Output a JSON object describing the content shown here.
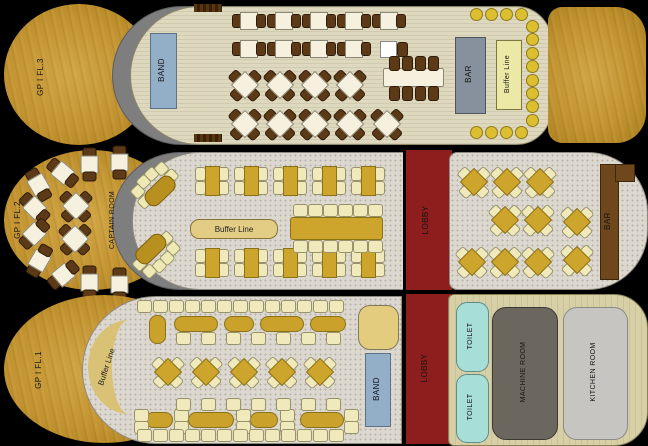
{
  "labels": {
    "deck3": {
      "floor": "GP I FL.3",
      "band": "BAND",
      "bar": "BAR",
      "buffet": "Buffer Line"
    },
    "deck2": {
      "floor": "GP I FL.2",
      "captain_room": "CAPTAIN ROOM",
      "buffet": "Buffer Line",
      "lobby": "LOBBY",
      "bar": "BAR"
    },
    "deck1": {
      "floor": "GP I FL.1",
      "buffet": "Buffer Line",
      "band": "BAND",
      "lobby": "LOBBY",
      "toilet_1": "TOILET",
      "toilet_2": "TOILET",
      "machine_room": "MACHINE  ROOM",
      "kitchen_room": "KITCHEN  ROOM"
    }
  },
  "colors": {
    "background": "#000000",
    "hull_wood": "#c29330",
    "hull_gray": "#7e7e7e",
    "deck_plank": "#ded8bf",
    "deck_carpet": "#dcd8d0",
    "lobby_red": "#8e1d1d",
    "band_blue": "#93aec7",
    "bar_gray": "#87909d",
    "bar_brown": "#6f471d",
    "buffet_yellow": "#ece8a5",
    "table_gold": "#cda52c",
    "chair_brown": "#5c3a18",
    "chair_cream": "#efe9bb",
    "stool_yellow": "#dcbf30",
    "toilet_cyan": "#a7ded7",
    "machine_gray": "#6b675f",
    "kitchen_gray": "#c6c5c2"
  },
  "furniture": {
    "fl3": [
      {
        "t": "hatch",
        "x": 190,
        "y": 0,
        "w": 28,
        "h": 8
      },
      {
        "t": "hatch",
        "x": 190,
        "y": 130,
        "w": 28,
        "h": 8
      },
      {
        "t": "row",
        "c": "t2h",
        "x": 228,
        "y": 8,
        "n": 5,
        "dx": 35
      },
      {
        "t": "row",
        "c": "t2h",
        "x": 228,
        "y": 36,
        "n": 4,
        "dx": 35
      },
      {
        "t": "wsq",
        "x": 376,
        "y": 37
      },
      {
        "t": "chb",
        "x": 393,
        "y": 38
      },
      {
        "t": "ltw",
        "x": 379,
        "y": 64,
        "w": 59,
        "h": 17
      },
      {
        "t": "row",
        "c": "chb",
        "x": 385,
        "y": 52,
        "n": 4,
        "dx": 13
      },
      {
        "t": "row",
        "c": "chb",
        "x": 385,
        "y": 82,
        "n": 4,
        "dx": 13
      },
      {
        "t": "row",
        "c": "dmb",
        "x": 223,
        "y": 63,
        "n": 4,
        "dx": 35
      },
      {
        "t": "row",
        "c": "dmb",
        "x": 223,
        "y": 102,
        "n": 4,
        "dx": 35
      },
      {
        "t": "dmb",
        "x": 365,
        "y": 102
      },
      {
        "t": "row",
        "c": "stool",
        "x": 466,
        "y": 4,
        "n": 4,
        "dx": 15
      },
      {
        "t": "row",
        "c": "stool",
        "x": 522,
        "y": 16,
        "n": 8,
        "dy": 13.4
      },
      {
        "t": "row",
        "c": "stool",
        "x": 466,
        "y": 122,
        "n": 4,
        "dx": 15
      }
    ],
    "fl2": [
      {
        "t": "t2h",
        "x": 69,
        "y": 6,
        "r": 90
      },
      {
        "t": "t2h",
        "x": 99,
        "y": 4,
        "r": 90
      },
      {
        "t": "t2h",
        "x": 42,
        "y": 14,
        "r": 40
      },
      {
        "t": "t2h",
        "x": 18,
        "y": 26,
        "r": 60
      },
      {
        "t": "t2h",
        "x": 14,
        "y": 49,
        "r": 45
      },
      {
        "t": "t2h",
        "x": 13,
        "y": 75,
        "r": -45
      },
      {
        "t": "dmb",
        "x": 54,
        "y": 38
      },
      {
        "t": "dmb",
        "x": 53,
        "y": 71
      },
      {
        "t": "t2h",
        "x": 18,
        "y": 102,
        "r": -60
      },
      {
        "t": "t2h",
        "x": 42,
        "y": 116,
        "r": -40
      },
      {
        "t": "t2h",
        "x": 69,
        "y": 124,
        "r": 90
      },
      {
        "t": "t2h",
        "x": 99,
        "y": 126,
        "r": 90
      },
      {
        "t": "sofa",
        "x": 130,
        "y": 18,
        "r": -44
      },
      {
        "t": "sofa",
        "x": 127,
        "y": 84,
        "r": 136
      },
      {
        "t": "row",
        "c": "u4",
        "x": 191,
        "y": 16,
        "n": 5,
        "dx": 39
      },
      {
        "t": "row",
        "c": "u4",
        "x": 191,
        "y": 98,
        "n": 5,
        "dx": 39
      },
      {
        "t": "ltg",
        "x": 286,
        "y": 67,
        "w": 91,
        "h": 21
      },
      {
        "t": "row",
        "c": "chc",
        "x": 289,
        "y": 54,
        "n": 6,
        "dx": 15
      },
      {
        "t": "row",
        "c": "chc",
        "x": 289,
        "y": 90,
        "n": 6,
        "dx": 15
      },
      {
        "t": "row",
        "c": "dmc",
        "x": 452,
        "y": 14,
        "n": 3,
        "dx": 33
      },
      {
        "t": "row",
        "c": "dmc",
        "x": 483,
        "y": 52,
        "n": 2,
        "dx": 33
      },
      {
        "t": "dmc",
        "x": 555,
        "y": 54
      },
      {
        "t": "row",
        "c": "dmc",
        "x": 450,
        "y": 94,
        "n": 3,
        "dx": 33
      },
      {
        "t": "dmc",
        "x": 555,
        "y": 92
      }
    ],
    "fl1": [
      {
        "t": "row",
        "c": "chc",
        "x": 133,
        "y": 7,
        "n": 13,
        "dx": 16
      },
      {
        "t": "pill",
        "x": 145,
        "y": 22,
        "w": 15,
        "h": 27
      },
      {
        "t": "pill",
        "x": 170,
        "y": 23,
        "w": 42,
        "h": 14
      },
      {
        "t": "pill",
        "x": 220,
        "y": 23,
        "w": 28,
        "h": 14
      },
      {
        "t": "pill",
        "x": 256,
        "y": 23,
        "w": 42,
        "h": 14
      },
      {
        "t": "pill",
        "x": 306,
        "y": 23,
        "w": 34,
        "h": 14
      },
      {
        "t": "row",
        "c": "chc",
        "x": 172,
        "y": 39,
        "n": 7,
        "dx": 25
      },
      {
        "t": "row",
        "c": "dmc",
        "x": 146,
        "y": 61,
        "n": 5,
        "dx": 38
      },
      {
        "t": "pill",
        "x": 141,
        "y": 119,
        "w": 26,
        "h": 14
      },
      {
        "t": "pill",
        "x": 184,
        "y": 119,
        "w": 44,
        "h": 14
      },
      {
        "t": "pill",
        "x": 246,
        "y": 119,
        "w": 26,
        "h": 14
      },
      {
        "t": "pill",
        "x": 296,
        "y": 119,
        "w": 42,
        "h": 14
      },
      {
        "t": "row",
        "c": "chc",
        "x": 130,
        "y": 116,
        "n": 2,
        "dy": 12
      },
      {
        "t": "row",
        "c": "chc",
        "x": 170,
        "y": 116,
        "n": 2,
        "dy": 12
      },
      {
        "t": "row",
        "c": "chc",
        "x": 232,
        "y": 116,
        "n": 2,
        "dy": 12
      },
      {
        "t": "row",
        "c": "chc",
        "x": 276,
        "y": 116,
        "n": 2,
        "dy": 12
      },
      {
        "t": "row",
        "c": "chc",
        "x": 340,
        "y": 116,
        "n": 2,
        "dy": 12
      },
      {
        "t": "row",
        "c": "chc",
        "x": 172,
        "y": 105,
        "n": 7,
        "dx": 25
      },
      {
        "t": "row",
        "c": "chc",
        "x": 133,
        "y": 136,
        "n": 13,
        "dx": 16
      }
    ]
  }
}
